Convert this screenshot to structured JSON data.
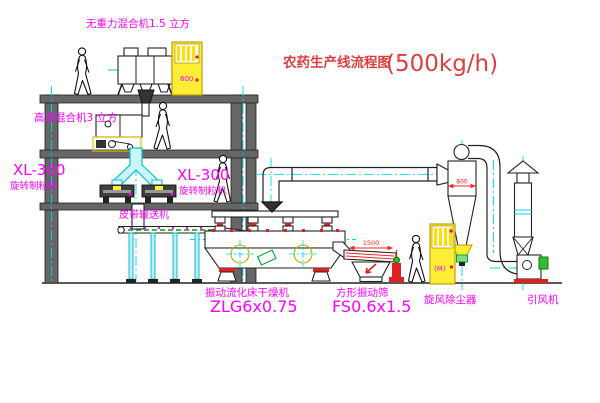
{
  "title": {
    "name": "农药生产线流程图",
    "capacity": "(500kg/h)"
  },
  "labels": {
    "gravity_mixer": "无重力混合机1.5 立方",
    "high_speed_mixer": "高速混合机3 立方",
    "granulator_left": {
      "model": "XL-300",
      "name": "旋转制粒机"
    },
    "granulator_right": {
      "model": "XL-300",
      "name": "旋转制粒机"
    },
    "belt_conveyor": "皮带输送机",
    "fluid_bed_dryer": {
      "name": "振动流化床干燥机",
      "model": "ZLG6x0.75"
    },
    "square_sieve": {
      "name": "方形振动筛",
      "model": "FS0.6x1.5"
    },
    "cyclone": "旋风除尘器",
    "induced_draft_fan": "引风机"
  },
  "dimensions": {
    "sieve_length": "1500",
    "cyclone_width": "800"
  },
  "cabinets": {
    "panel_top": "600",
    "panel_ground": "(M)"
  },
  "colors": {
    "label_magenta": "#ff00ff",
    "title_red": "#d94040",
    "dimension_red": "#ff2020",
    "centerline_cyan": "#00d8e4",
    "structure_gray": "#5f5f5f",
    "cabinet_yellow": "#ffee33",
    "valve_green": "#00aa33",
    "belt_green": "#00a000",
    "background": "#ffffff"
  }
}
